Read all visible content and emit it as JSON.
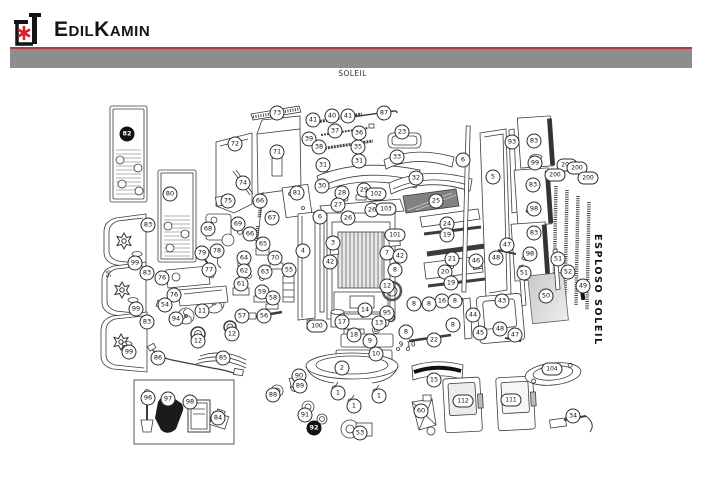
{
  "header": {
    "brand": "EdilKamin",
    "logo": "edilkamin-chimney-flower-logo"
  },
  "page": {
    "model_title": "SOLEIL",
    "side_label": "ESPLOSO SOLEIL"
  },
  "colors": {
    "logo_red": "#d5202a",
    "rule_red": "#b13c3b",
    "bar_gray": "#8d8d8f",
    "line": "#3c3c3c",
    "glass_gray": "#d4d4d4"
  },
  "diagram": {
    "description": "Exploded parts diagram of SOLEIL stove with numbered callouts",
    "callouts": [
      [
        "82",
        127,
        134,
        "f"
      ],
      [
        "80",
        170,
        194
      ],
      [
        "73",
        277,
        113
      ],
      [
        "72",
        235,
        144
      ],
      [
        "71",
        277,
        152
      ],
      [
        "74",
        243,
        183
      ],
      [
        "75",
        228,
        201
      ],
      [
        "41",
        313,
        120
      ],
      [
        "40",
        332,
        116
      ],
      [
        "41",
        348,
        116
      ],
      [
        "87",
        384,
        113
      ],
      [
        "39",
        309,
        139
      ],
      [
        "37",
        335,
        131
      ],
      [
        "36",
        359,
        133
      ],
      [
        "38",
        319,
        147
      ],
      [
        "35",
        358,
        147
      ],
      [
        "23",
        402,
        132
      ],
      [
        "31",
        323,
        165
      ],
      [
        "31",
        359,
        161
      ],
      [
        "33",
        397,
        157
      ],
      [
        "32",
        416,
        178
      ],
      [
        "30",
        322,
        186
      ],
      [
        "81",
        297,
        193
      ],
      [
        "28",
        342,
        193
      ],
      [
        "29",
        364,
        190
      ],
      [
        "102",
        376,
        194,
        "w"
      ],
      [
        "27",
        338,
        205
      ],
      [
        "26",
        372,
        210
      ],
      [
        "103",
        386,
        209,
        "w"
      ],
      [
        "26",
        348,
        218
      ],
      [
        "25",
        436,
        201
      ],
      [
        "6",
        463,
        160
      ],
      [
        "93",
        512,
        142
      ],
      [
        "83",
        534,
        141
      ],
      [
        "99",
        535,
        163
      ],
      [
        "5",
        493,
        177
      ],
      [
        "200",
        567,
        165,
        "w"
      ],
      [
        "200",
        577,
        168,
        "w"
      ],
      [
        "200",
        555,
        175,
        "w"
      ],
      [
        "200",
        588,
        178,
        "w"
      ],
      [
        "83",
        533,
        185
      ],
      [
        "98",
        534,
        209
      ],
      [
        "83",
        534,
        233
      ],
      [
        "98",
        530,
        254
      ],
      [
        "6",
        320,
        217
      ],
      [
        "3",
        333,
        243
      ],
      [
        "4",
        303,
        251
      ],
      [
        "42",
        330,
        262
      ],
      [
        "55",
        289,
        270
      ],
      [
        "101",
        395,
        235,
        "w"
      ],
      [
        "7",
        387,
        253
      ],
      [
        "42",
        400,
        256
      ],
      [
        "8",
        395,
        270
      ],
      [
        "24",
        447,
        224
      ],
      [
        "19",
        447,
        235
      ],
      [
        "21",
        452,
        259
      ],
      [
        "20",
        445,
        272
      ],
      [
        "19",
        451,
        283
      ],
      [
        "66",
        260,
        201
      ],
      [
        "67",
        272,
        218
      ],
      [
        "69",
        238,
        224
      ],
      [
        "68",
        208,
        229
      ],
      [
        "66",
        250,
        234
      ],
      [
        "65",
        263,
        244
      ],
      [
        "64",
        244,
        258
      ],
      [
        "70",
        275,
        258
      ],
      [
        "62",
        244,
        271
      ],
      [
        "63",
        265,
        272
      ],
      [
        "61",
        241,
        284
      ],
      [
        "59",
        262,
        292
      ],
      [
        "58",
        273,
        298
      ],
      [
        "57",
        242,
        316
      ],
      [
        "56",
        264,
        316
      ],
      [
        "79",
        202,
        253
      ],
      [
        "78",
        217,
        251
      ],
      [
        "77",
        209,
        270
      ],
      [
        "83",
        148,
        225
      ],
      [
        "99",
        135,
        263
      ],
      [
        "83",
        147,
        273
      ],
      [
        "95",
        107,
        274,
        "v"
      ],
      [
        "99",
        136,
        309
      ],
      [
        "83",
        147,
        322
      ],
      [
        "99",
        129,
        352
      ],
      [
        "76",
        162,
        278
      ],
      [
        "76",
        174,
        295
      ],
      [
        "54",
        165,
        305
      ],
      [
        "94",
        176,
        319
      ],
      [
        "11",
        202,
        311
      ],
      [
        "12",
        198,
        341
      ],
      [
        "12",
        232,
        334
      ],
      [
        "86",
        158,
        358
      ],
      [
        "85",
        223,
        358
      ],
      [
        "12",
        387,
        286
      ],
      [
        "95",
        387,
        313
      ],
      [
        "14",
        365,
        310
      ],
      [
        "13",
        379,
        323
      ],
      [
        "17",
        342,
        322
      ],
      [
        "100",
        317,
        326,
        "w"
      ],
      [
        "16",
        442,
        301
      ],
      [
        "8",
        414,
        304
      ],
      [
        "8",
        429,
        304
      ],
      [
        "8",
        455,
        301
      ],
      [
        "8",
        453,
        325
      ],
      [
        "18",
        354,
        335
      ],
      [
        "8",
        406,
        332
      ],
      [
        "9",
        370,
        341
      ],
      [
        "10",
        376,
        354
      ],
      [
        "9",
        401,
        345,
        "p"
      ],
      [
        "10",
        411,
        345,
        "p"
      ],
      [
        "22",
        434,
        340
      ],
      [
        "2",
        342,
        368
      ],
      [
        "15",
        434,
        380
      ],
      [
        "46",
        476,
        261
      ],
      [
        "48",
        496,
        258
      ],
      [
        "47",
        507,
        245
      ],
      [
        "43",
        502,
        301
      ],
      [
        "44",
        473,
        315
      ],
      [
        "45",
        480,
        333
      ],
      [
        "48",
        500,
        329
      ],
      [
        "47",
        515,
        335
      ],
      [
        "51",
        524,
        273
      ],
      [
        "51",
        558,
        259
      ],
      [
        "52",
        568,
        272
      ],
      [
        "49",
        583,
        286
      ],
      [
        "50",
        546,
        296
      ],
      [
        "90",
        299,
        376
      ],
      [
        "89",
        300,
        386
      ],
      [
        "88",
        273,
        395
      ],
      [
        "91",
        305,
        415
      ],
      [
        "92",
        314,
        428,
        "f"
      ],
      [
        "1",
        338,
        393
      ],
      [
        "1",
        379,
        396
      ],
      [
        "1",
        354,
        406
      ],
      [
        "53",
        360,
        433
      ],
      [
        "60",
        421,
        411
      ],
      [
        "112",
        463,
        401,
        "w"
      ],
      [
        "111",
        511,
        400,
        "w"
      ],
      [
        "104",
        552,
        369,
        "w"
      ],
      [
        "34",
        573,
        416
      ],
      [
        "96",
        148,
        398
      ],
      [
        "97",
        168,
        399
      ],
      [
        "98",
        190,
        402
      ],
      [
        "84",
        218,
        418
      ]
    ]
  }
}
